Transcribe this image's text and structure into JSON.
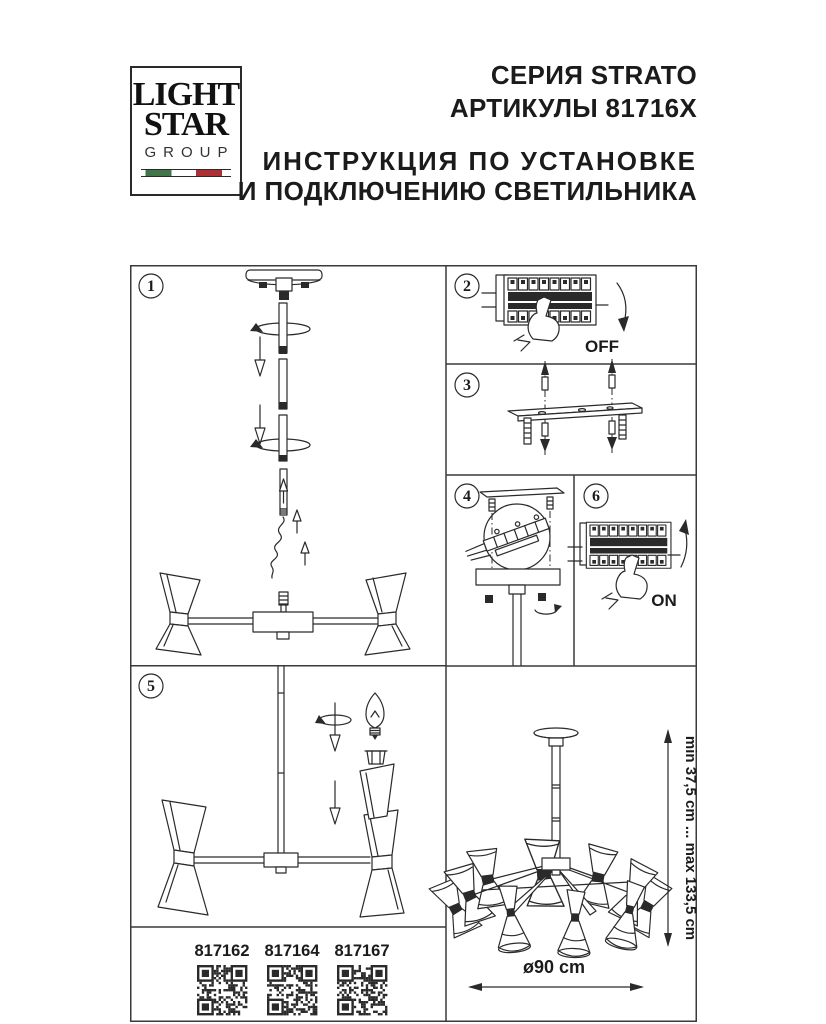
{
  "header": {
    "logo": {
      "line1": "LIGHT",
      "line2": "STAR",
      "line3": "GROUP"
    },
    "series": "СЕРИЯ STRATO",
    "articles_line": "АРТИКУЛЫ 81716X",
    "instruction1": "ИНСТРУКЦИЯ ПО УСТАНОВКЕ",
    "instruction2": "И ПОДКЛЮЧЕНИЮ СВЕТИЛЬНИКА"
  },
  "steps": {
    "s1": "1",
    "s2": "2",
    "s3": "3",
    "s4": "4",
    "s5": "5",
    "s6": "6"
  },
  "labels": {
    "power_off": "OFF",
    "power_on": "ON"
  },
  "articles": [
    "817162",
    "817164",
    "817167"
  ],
  "dimensions": {
    "height_range": "min 37,5 cm ... max 133,5 cm",
    "diameter": "ø90 cm"
  },
  "colors": {
    "line": "#2a2a2a",
    "flag_green": "#42764a",
    "flag_red": "#ae2f34"
  }
}
